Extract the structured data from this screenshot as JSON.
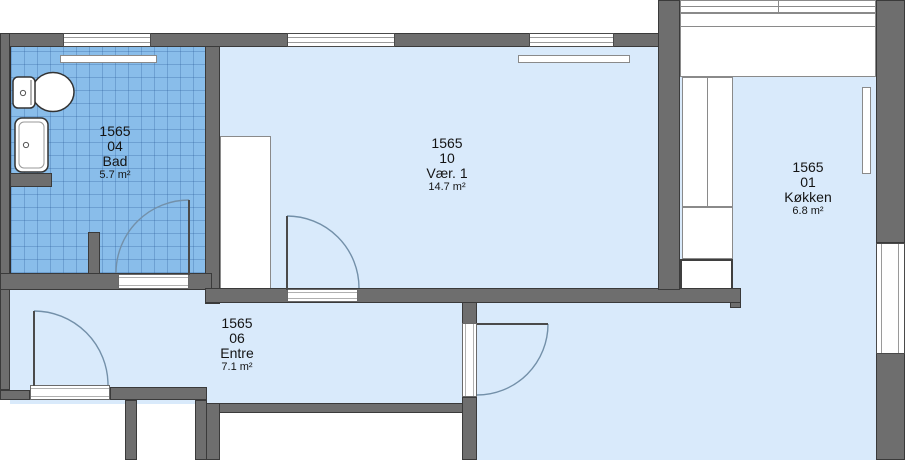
{
  "plan_title": "Apartment floor plan 1565",
  "rooms": [
    {
      "key": "bad",
      "unit": "1565",
      "number": "04",
      "name": "Bad",
      "area": "5.7 m²"
    },
    {
      "key": "vaer1",
      "unit": "1565",
      "number": "10",
      "name": "Vær. 1",
      "area": "14.7 m²"
    },
    {
      "key": "kokken",
      "unit": "1565",
      "number": "01",
      "name": "Køkken",
      "area": "6.8 m²"
    },
    {
      "key": "entre",
      "unit": "1565",
      "number": "06",
      "name": "Entre",
      "area": "7.1 m²"
    }
  ],
  "colors": {
    "wall": "#6e6e6e",
    "wall_outline": "#3a3a3a",
    "floor": "#d9eafb",
    "bath_tile": "#89bdea",
    "background": "#ffffff",
    "door_swing": "#7390a9"
  },
  "fixtures": {
    "toilet": "toilet-icon",
    "sink": "sink-icon",
    "radiators": 3,
    "kitchen_cabinets": 4,
    "wardrobe": 1,
    "windows": 5,
    "doors": 4
  }
}
